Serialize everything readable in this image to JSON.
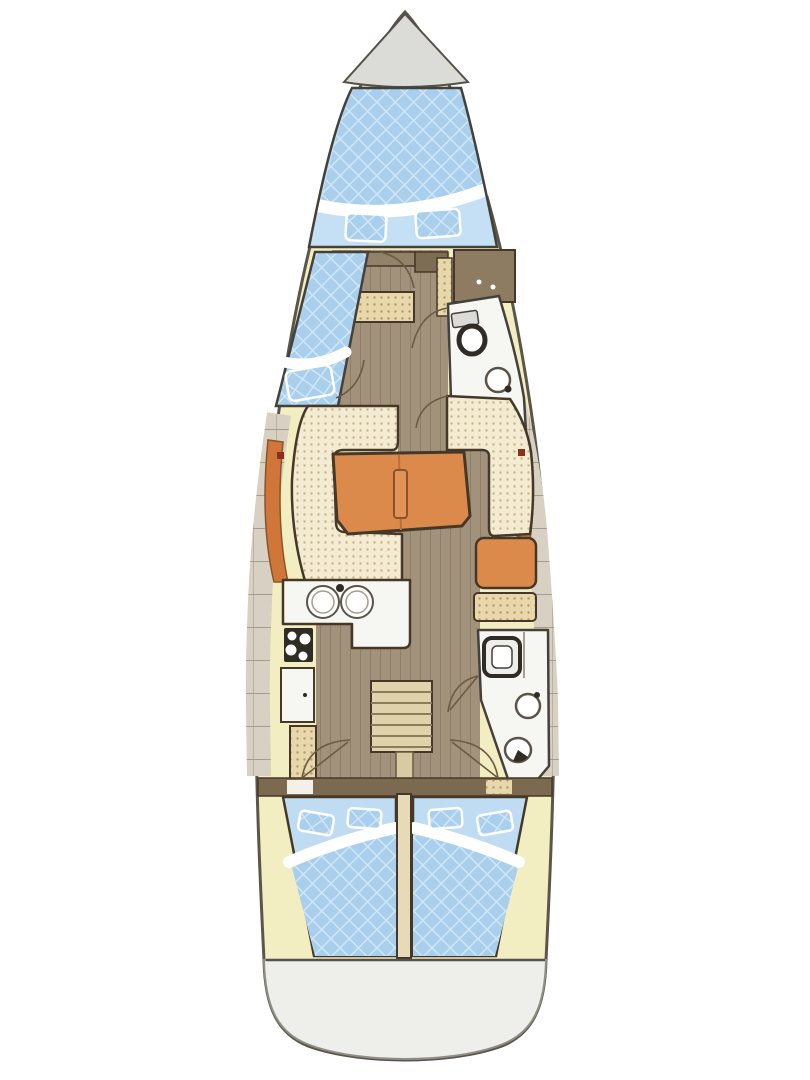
{
  "diagram": {
    "kind": "sailing-yacht-interior-deck-plan",
    "orientation": "bow-at-top",
    "background": "#ffffff"
  },
  "palette": {
    "hullOutline": "#5a564a",
    "deckYellow": "#f3edc2",
    "anchorLockerGray": "#dbdbd8",
    "mattressBlue": "#a9cfec",
    "mattressQuiltLine": "#cfe6f8",
    "cabinFloorBlue": "#c5e0f4",
    "aftCabinBlue": "#bfdcf2",
    "woodFloor": "#a2927c",
    "woodPlankLine": "#897960",
    "lockerGray": "#d7d0c3",
    "lockerLine": "#a59d8e",
    "cushionCream": "#f3ebd2",
    "cushionDot": "#c9b488",
    "seatTan": "#e8d7ab",
    "seatTanDot": "#b59a66",
    "orangeMain": "#dc8a4b",
    "orangeDeep": "#d0763a",
    "orangeEdge": "#8a5526",
    "tableLeafLine": "#b96f35",
    "tableHandle": "#e0945a",
    "furnitureOutline": "#463828",
    "fixtureWhite": "#f6f6f3",
    "fixtureOutline": "#44403a",
    "applianceDark": "#2f2c26",
    "cabinetBrown": "#8d7b62",
    "cabinetBrownDark": "#7e6d55",
    "cabinetBrownLight": "#93826a",
    "bulkheadBrown": "#7c6a50",
    "bulkheadGapWhite": "#f2f0e8",
    "stepsTan": "#e0d3ab",
    "stepsLine": "#8d7c58",
    "enginePost": "#d9cba1",
    "dividerCream": "#e6dbb6",
    "transomGray": "#eeeeea",
    "transomOutline": "#8f8f86",
    "sternLine": "#55504a",
    "portholeRed": "#8e2f1d",
    "white": "#ffffff",
    "doorArc": "#6b5b43",
    "sinkRim": "#5a5448"
  },
  "regions": [
    {
      "name": "anchor-locker",
      "position": "bow-tip"
    },
    {
      "name": "v-berth-forward-cabin",
      "position": "bow",
      "features": [
        "double-quilted-mattress",
        "white-foot-board",
        "two-seat-cushions"
      ]
    },
    {
      "name": "port-single-berth",
      "position": "port-midship-forward",
      "features": [
        "quilted-mattress",
        "white-pillow-band",
        "foot-cushion"
      ]
    },
    {
      "name": "forward-head",
      "position": "starboard-midship-forward",
      "features": [
        "toilet",
        "sink"
      ]
    },
    {
      "name": "wardrobe-cabinet",
      "position": "starboard-forward",
      "features": [
        "two-knobs"
      ]
    },
    {
      "name": "saloon",
      "position": "midship",
      "features": [
        "port-c-shaped-settee",
        "orange-folding-table",
        "starboard-settee",
        "orange-backrests",
        "portside-red-marker",
        "starboardside-red-marker"
      ]
    },
    {
      "name": "nav-station",
      "position": "starboard-aft-of-saloon",
      "features": [
        "orange-chart-desk",
        "tan-seat"
      ]
    },
    {
      "name": "galley",
      "position": "port-aft",
      "features": [
        "l-shaped-counter",
        "double-round-sinks",
        "faucet",
        "stove-with-burners",
        "fridge",
        "tan-locker"
      ]
    },
    {
      "name": "aft-head",
      "position": "starboard-aft",
      "features": [
        "shower-tray",
        "sink",
        "toilet",
        "tan-cabinet"
      ]
    },
    {
      "name": "companionway",
      "position": "centerline-aft",
      "features": [
        "steps",
        "engine-box-post"
      ]
    },
    {
      "name": "aft-cabin-port",
      "features": [
        "double-quilted-mattress",
        "white-pillow-band",
        "two-pillows"
      ]
    },
    {
      "name": "aft-cabin-starboard",
      "features": [
        "double-quilted-mattress",
        "white-pillow-band",
        "two-pillows"
      ]
    },
    {
      "name": "side-lockers",
      "position": "both-hull-sides-midship"
    },
    {
      "name": "side-decks",
      "position": "both-hull-sides-bow-and-stern"
    },
    {
      "name": "transom-swim-platform",
      "position": "stern"
    }
  ]
}
